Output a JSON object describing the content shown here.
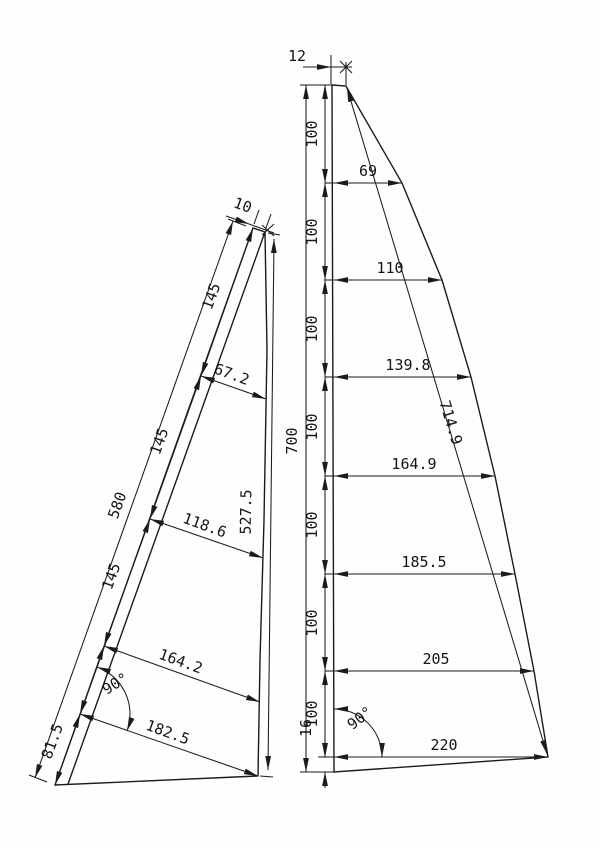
{
  "drawing": {
    "jib": {
      "head_width": "10",
      "luff_total": "580",
      "luff_segments": [
        "145",
        "145",
        "145"
      ],
      "luff_tack_segment": "81.5",
      "girths": [
        "67.2",
        "118.6",
        "164.2",
        "182.5"
      ],
      "leech_length": "527.5",
      "clew_angle": "90°"
    },
    "main": {
      "head_width": "12",
      "luff_total": "700",
      "luff_segments": [
        "100",
        "100",
        "100",
        "100",
        "100",
        "100",
        "100"
      ],
      "girths": [
        "69",
        "110",
        "139.8",
        "164.9",
        "185.5",
        "205",
        "220"
      ],
      "leech_length": "714.9",
      "tack_offset": "16",
      "clew_angle": "90°"
    },
    "colors": {
      "line": "#1b1b1b",
      "background": "#fefefe"
    }
  }
}
